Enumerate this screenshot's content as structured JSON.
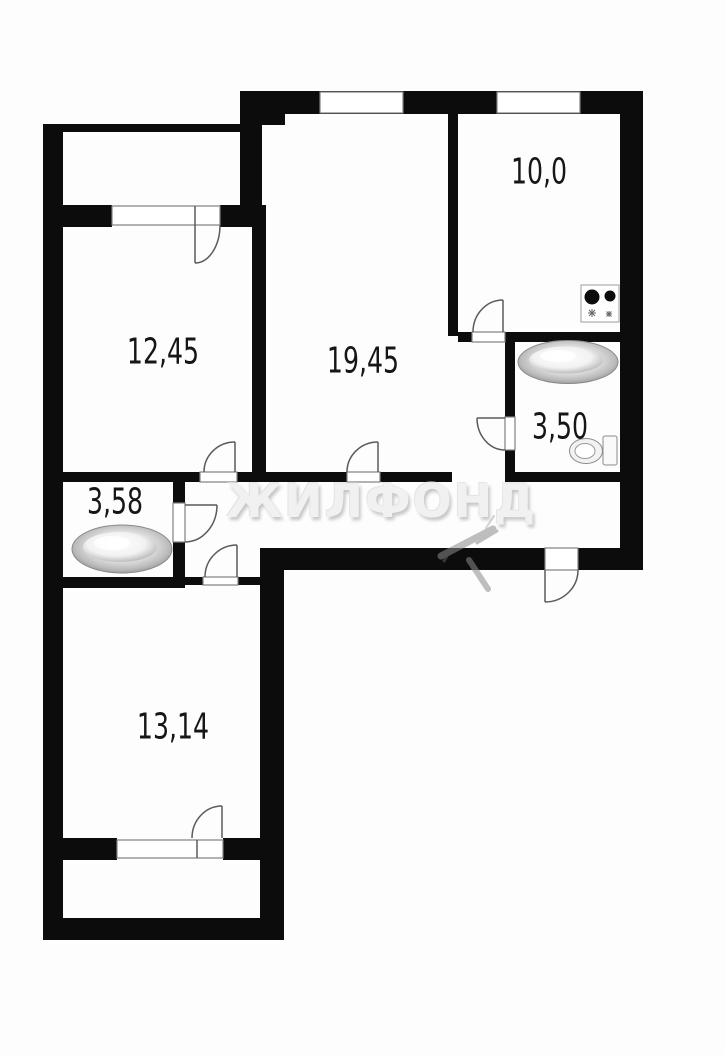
{
  "watermark": {
    "text": "ЖИЛФОНД"
  },
  "rooms": [
    {
      "name": "room-large",
      "area": "19,45"
    },
    {
      "name": "room-left",
      "area": "12,45"
    },
    {
      "name": "kitchen",
      "area": "10,0"
    },
    {
      "name": "bathroom-right",
      "area": "3,50"
    },
    {
      "name": "bathroom-left",
      "area": "3,58"
    },
    {
      "name": "room-bottom",
      "area": "13,14"
    }
  ],
  "fixtures": [
    {
      "icon": "bathtub-icon",
      "location": "bathroom-left"
    },
    {
      "icon": "bathtub-icon",
      "location": "bathroom-right"
    },
    {
      "icon": "toilet-icon",
      "location": "bathroom-right"
    },
    {
      "icon": "stove-icon",
      "location": "kitchen"
    }
  ],
  "colors": {
    "wall": "#0c0c0c",
    "line": "#5a5a5a",
    "label_text": "#161616",
    "watermark": "#f1f1f1"
  }
}
